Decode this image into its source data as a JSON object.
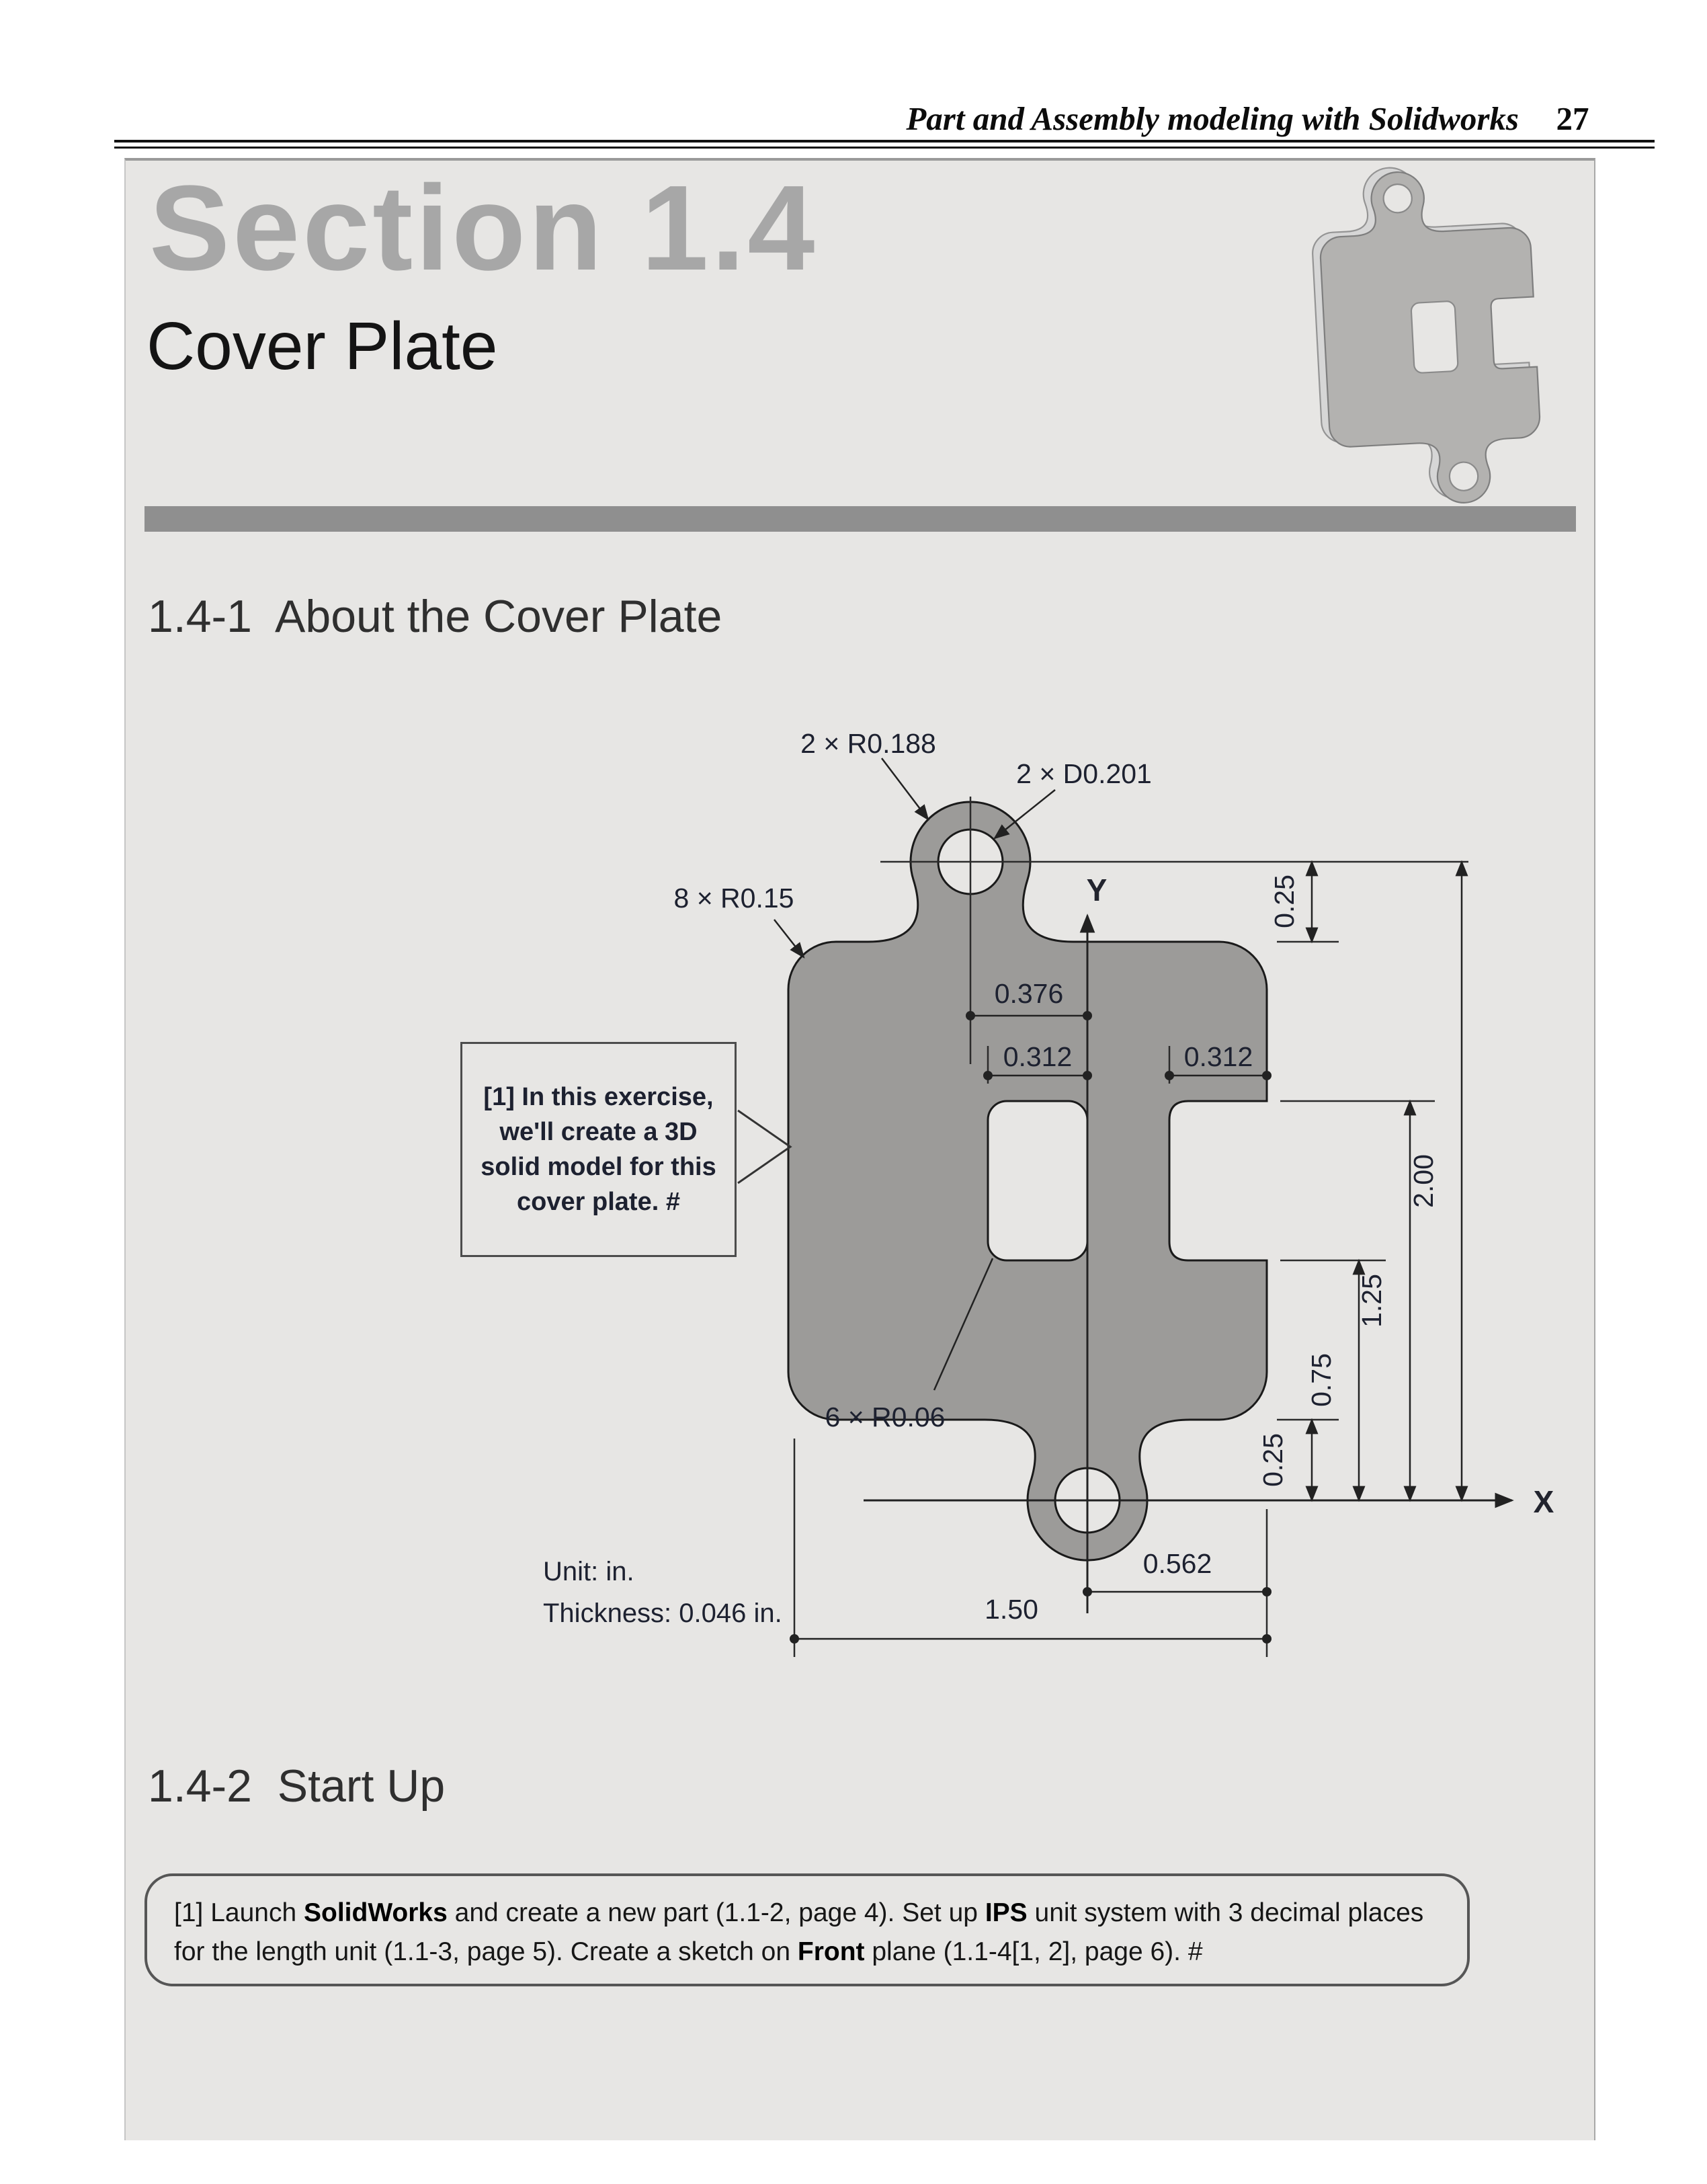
{
  "header": {
    "title": "Part and Assembly modeling with Solidworks",
    "page_number": "27"
  },
  "section": {
    "title": "Section 1.4",
    "subtitle": "Cover Plate"
  },
  "headings": {
    "about": "1.4-1  About the Cover Plate",
    "startup": "1.4-2  Start Up"
  },
  "callout": {
    "lines": [
      "[1] In this exercise,",
      "we'll create a 3D",
      "solid model for this",
      "cover plate. #"
    ]
  },
  "notes": {
    "unit": "Unit: in.",
    "thickness": "Thickness: 0.046 in."
  },
  "drawing": {
    "axes": {
      "x": "X",
      "y": "Y"
    },
    "dimensions": {
      "lug_radius": "2 × R0.188",
      "hole_diameter": "2 × D0.201",
      "corner_radius": "8 × R0.15",
      "inner_radius": "6 × R0.06",
      "lug_offset": "0.376",
      "slot_width": "0.312",
      "notch_depth": "0.312",
      "lug_top_offset": "0.25",
      "total_height": "2.00",
      "notch_top_height": "1.25",
      "notch_bottom_height": "0.75",
      "lug_bottom_offset": "0.25",
      "right_offset": "0.562",
      "plate_width": "1.50"
    }
  },
  "instructions": {
    "segments": [
      "[1] Launch ",
      "SolidWorks",
      " and create a new part (1.1-2, page 4).  Set up ",
      "IPS",
      " unit system with 3 decimal places",
      "for the length unit (1.1-3, page 5).  Create a sketch on ",
      "Front",
      " plane (1.1-4[1, 2], page 6). #"
    ]
  }
}
